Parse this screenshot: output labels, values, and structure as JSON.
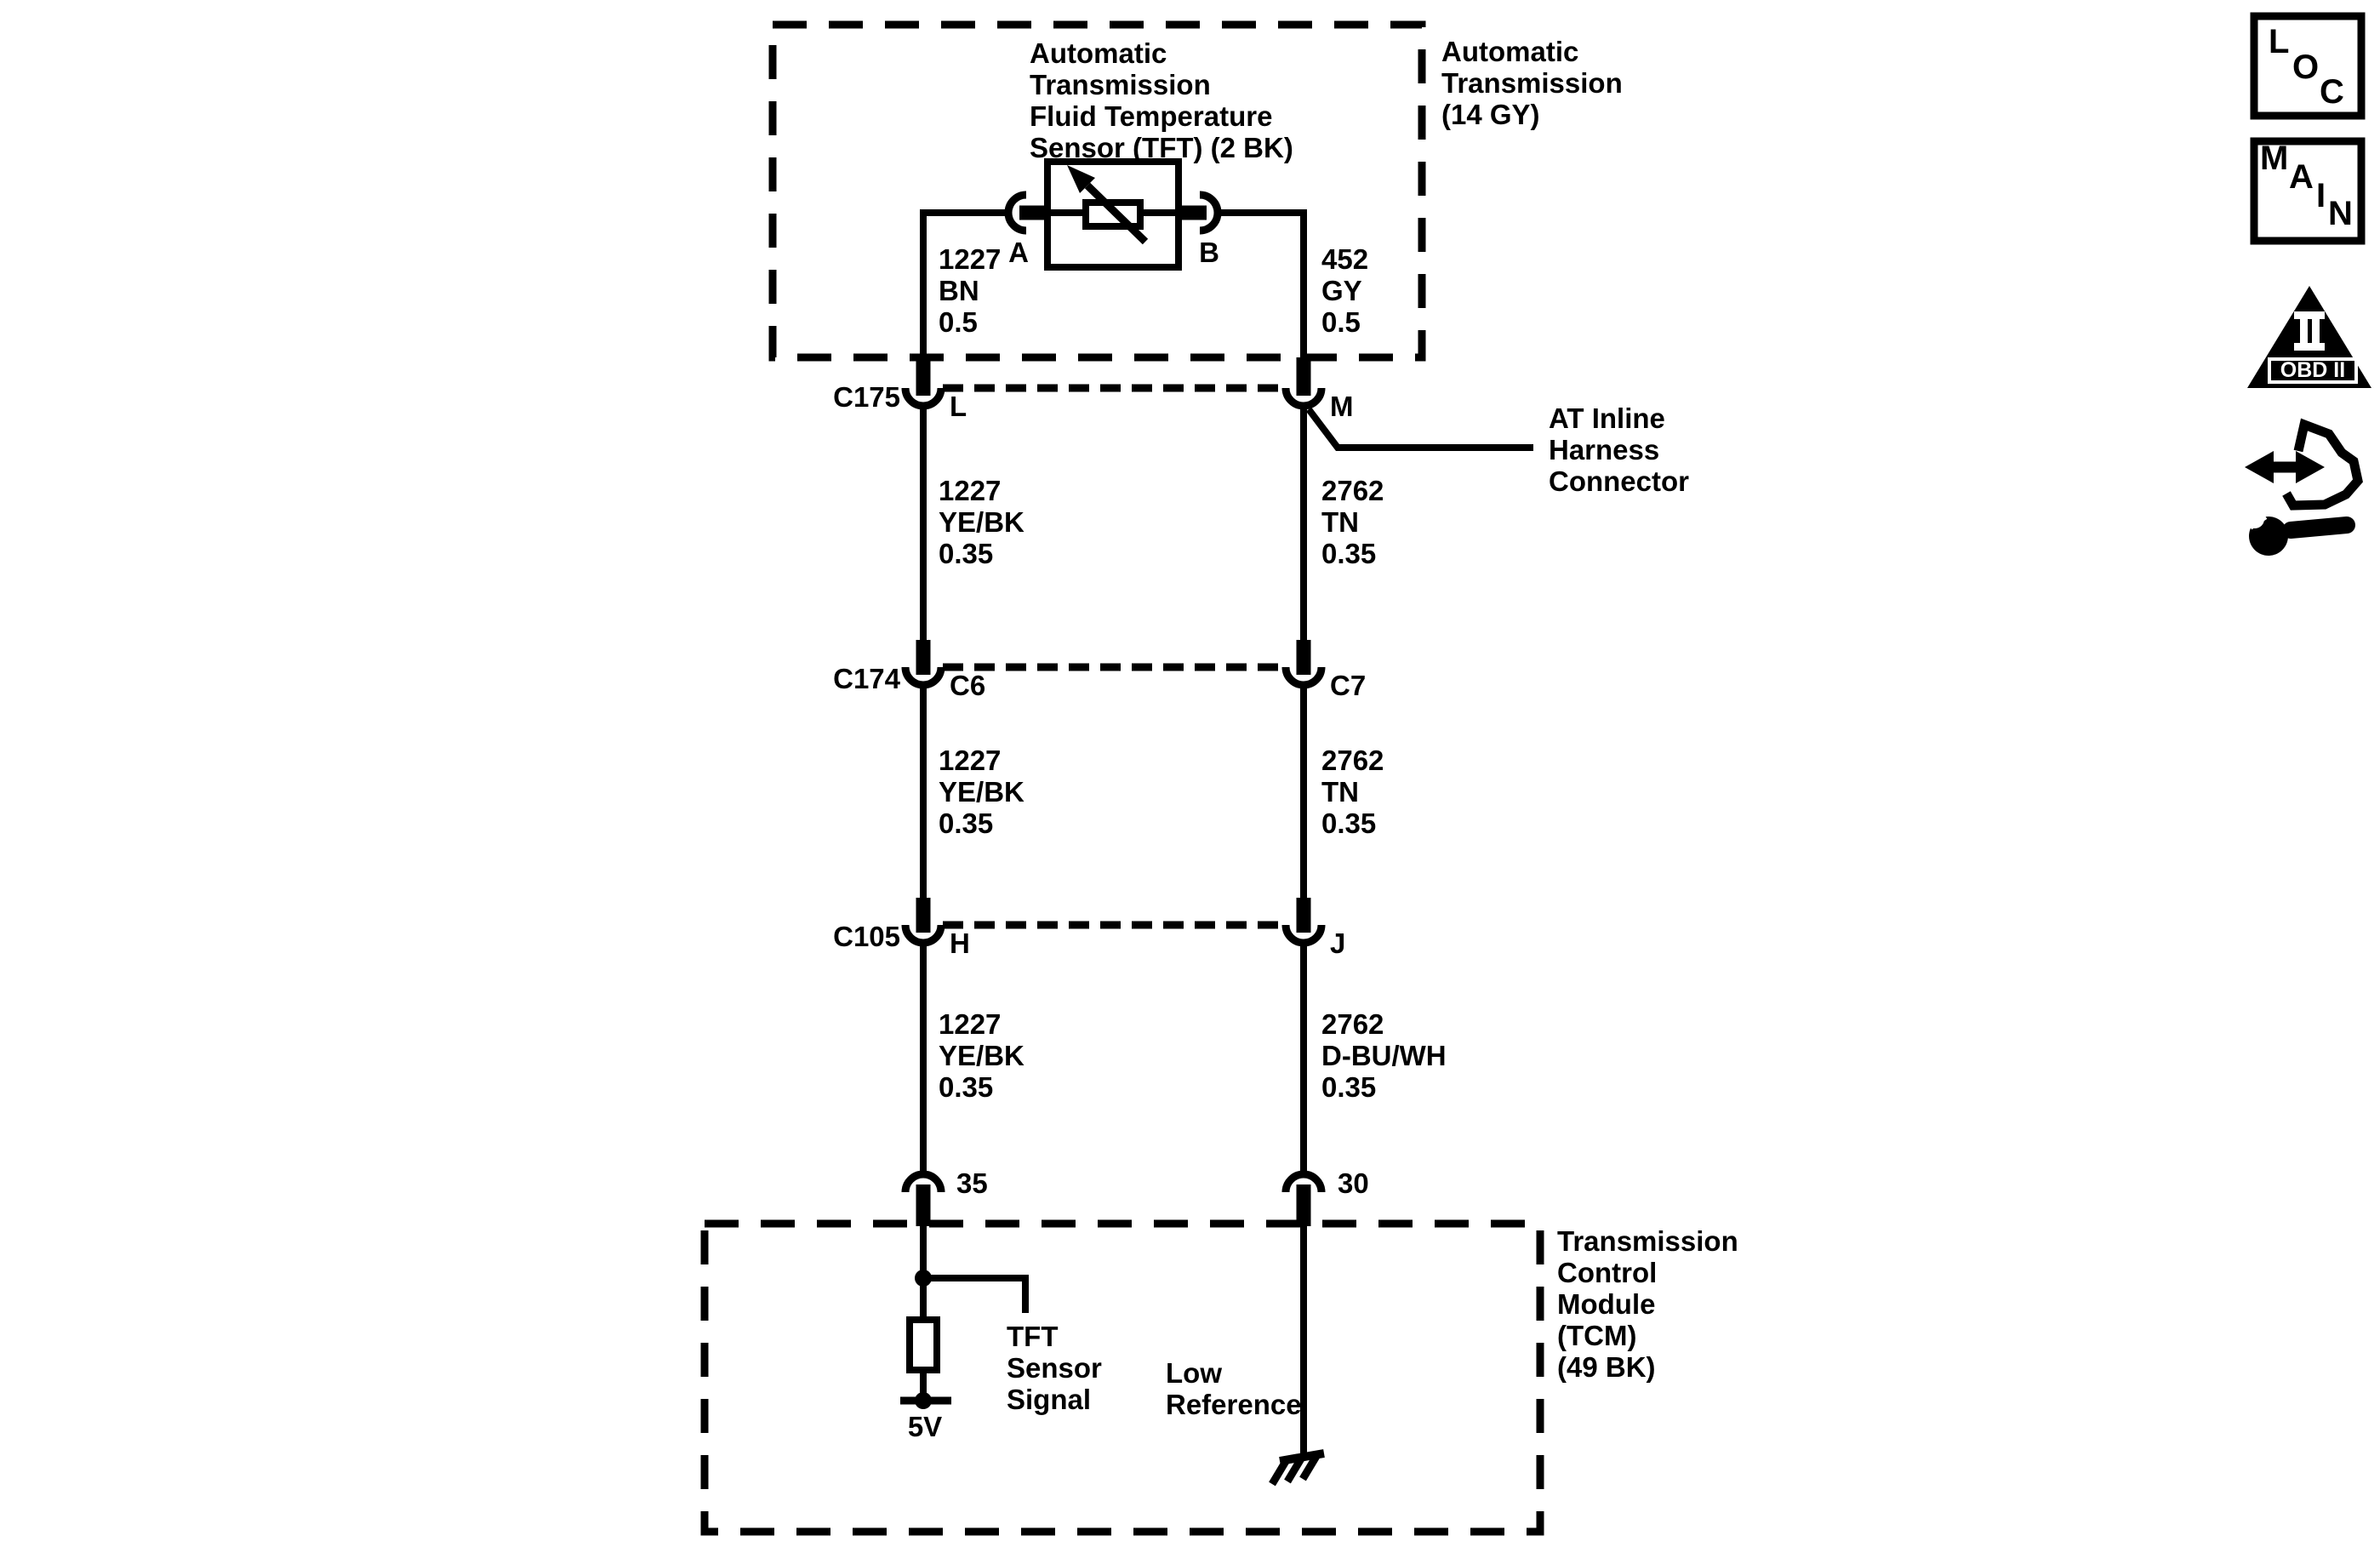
{
  "colors": {
    "ink": "#000000",
    "paper": "#ffffff"
  },
  "transmission_box": {
    "label": [
      "Automatic",
      "Transmission",
      "(14 GY)"
    ]
  },
  "sensor": {
    "label": [
      "Automatic",
      "Transmission",
      "Fluid Temperature",
      "Sensor (TFT) (2 BK)"
    ],
    "pin_a": "A",
    "pin_b": "B"
  },
  "inline_note": [
    "AT Inline",
    "Harness",
    "Connector"
  ],
  "wire_segments": {
    "sensor_a": [
      "1227",
      "BN",
      "0.5"
    ],
    "sensor_b": [
      "452",
      "GY",
      "0.5"
    ],
    "c175_l": [
      "1227",
      "YE/BK",
      "0.35"
    ],
    "c175_m": [
      "2762",
      "TN",
      "0.35"
    ],
    "c174_c6": [
      "1227",
      "YE/BK",
      "0.35"
    ],
    "c174_c7": [
      "2762",
      "TN",
      "0.35"
    ],
    "c105_h": [
      "1227",
      "YE/BK",
      "0.35"
    ],
    "c105_j": [
      "2762",
      "D-BU/WH",
      "0.35"
    ]
  },
  "connectors": {
    "c175": {
      "name": "C175",
      "left_pin": "L",
      "right_pin": "M"
    },
    "c174": {
      "name": "C174",
      "left_pin": "C6",
      "right_pin": "C7"
    },
    "c105": {
      "name": "C105",
      "left_pin": "H",
      "right_pin": "J"
    }
  },
  "tcm": {
    "label": [
      "Transmission",
      "Control",
      "Module",
      "(TCM)",
      "(49 BK)"
    ],
    "pin_35": "35",
    "pin_30": "30",
    "tft_signal": [
      "TFT",
      "Sensor",
      "Signal"
    ],
    "low_reference": [
      "Low",
      "Reference"
    ],
    "supply": "5V"
  },
  "toolbar_icons": {
    "loc": [
      "L",
      "O",
      "C"
    ],
    "main": [
      "M",
      "A",
      "I",
      "N"
    ],
    "obd_plate": "OBD II"
  }
}
